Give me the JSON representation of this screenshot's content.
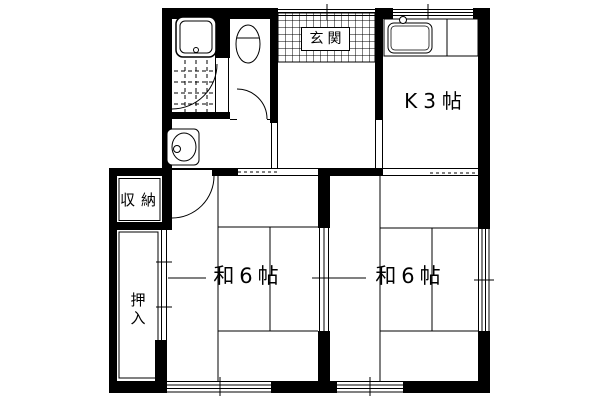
{
  "colors": {
    "line": "#000000",
    "background": "#ffffff"
  },
  "rooms": {
    "entrance": {
      "label": "玄関"
    },
    "kitchen": {
      "label": "K3帖"
    },
    "storage": {
      "label": "収納"
    },
    "closet": {
      "label": "押入"
    },
    "tatami_left": {
      "label": "和6帖"
    },
    "tatami_right": {
      "label": "和6帖"
    }
  }
}
